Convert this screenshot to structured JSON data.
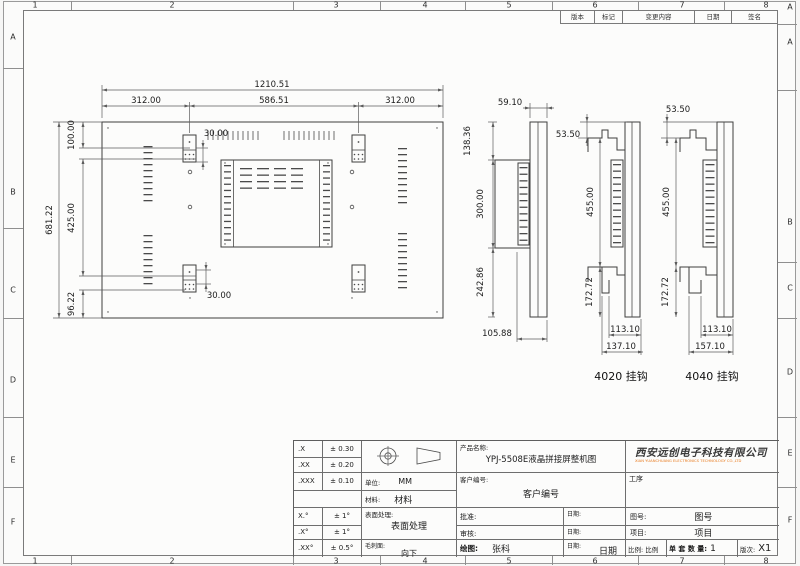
{
  "frame": {
    "top_cols": [
      "1",
      "2",
      "3",
      "4",
      "5",
      "6",
      "7",
      "8"
    ],
    "bottom_cols": [
      "1",
      "2",
      "3",
      "4",
      "5",
      "6",
      "7",
      "8"
    ],
    "left_rows": [
      "A",
      "B",
      "C",
      "D",
      "E",
      "F"
    ],
    "right_rows": [
      "A",
      "A",
      "B",
      "C",
      "D",
      "E",
      "F"
    ]
  },
  "revision_table": {
    "headers": [
      "版本",
      "标记",
      "变更内容",
      "日期",
      "签名"
    ]
  },
  "views": {
    "main": {
      "dims": {
        "total_width": "1210.51",
        "left": "312.00",
        "center": "586.51",
        "right": "312.00",
        "hook_offset_top": "30.00",
        "hook_offset_bottom": "30.00",
        "top_offset": "100.00",
        "total_height": "681.22",
        "hook_span": "425.00",
        "bottom_offset": "96.22"
      }
    },
    "side": {
      "dims": {
        "front_depth": "59.10",
        "upper": "138.36",
        "box_height": "300.00",
        "lower": "242.86",
        "total_depth": "105.88"
      }
    },
    "hook_4020": {
      "label": "4020 挂钩",
      "dims": {
        "top_gap": "53.50",
        "hook_span": "455.00",
        "bottom_gap": "172.72",
        "inner_width": "113.10",
        "outer_width": "137.10"
      }
    },
    "hook_4040": {
      "label": "4040 挂钩",
      "dims": {
        "top_gap": "53.50",
        "hook_span": "455.00",
        "bottom_gap": "172.72",
        "inner_width": "113.10",
        "outer_width": "157.10"
      }
    }
  },
  "title_block": {
    "tolerances": [
      {
        "label": ".X",
        "value": "± 0.30"
      },
      {
        "label": ".XX",
        "value": "± 0.20"
      },
      {
        "label": ".XXX",
        "value": "± 0.10"
      },
      {
        "label": "X.°",
        "value": "± 1°"
      },
      {
        "label": ".X°",
        "value": "± 1°"
      },
      {
        "label": ".XX°",
        "value": "± 0.5°"
      }
    ],
    "unit_label": "单位:",
    "unit_value": "MM",
    "material_label": "材料:",
    "material_value": "材料",
    "surface_label": "表面处理:",
    "surface_value": "表面处理",
    "burr_label": "毛刺面:",
    "burr_value": "向下",
    "product_name_label": "产品名称:",
    "product_name": "YPJ-5508E液晶拼接屏整机图",
    "customer_no_label": "客户编号:",
    "customer_no_value": "客户编号",
    "approved_label": "批准:",
    "checked_label": "审核:",
    "drawn_label": "绘图:",
    "drawn_value": "张科",
    "date_label": "日期:",
    "date_value": "日期",
    "process_label": "工序",
    "drawing_no_label": "图号:",
    "drawing_no_value": "图号",
    "project_label": "项目:",
    "project_value": "项目",
    "scale_label": "比例:",
    "scale_value": "比例",
    "qty_label": "单 套 数 量:",
    "qty_value": "1",
    "revision_label": "版次:",
    "revision_value": "X1"
  },
  "company": {
    "name": "西安远创电子科技有限公司",
    "name_en": "XIAN YUANCHUANG ELECTRONICS TECHNOLOGY CO.,LTD"
  },
  "colors": {
    "accent": "#e87a1e",
    "line": "#3e3e3e",
    "frame": "#8f8f8f"
  }
}
